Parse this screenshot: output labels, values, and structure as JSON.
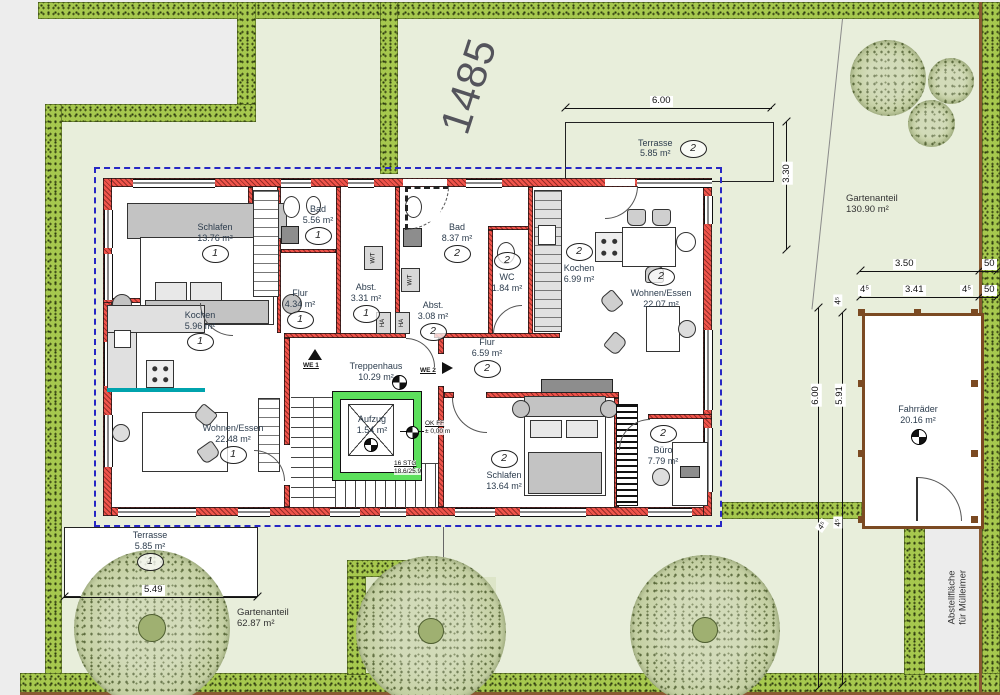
{
  "site": {
    "parcel_number": "1485",
    "garden_share_right": {
      "name": "Gartenanteil",
      "area": "130.90 m²"
    },
    "garden_share_left": {
      "name": "Gartenanteil",
      "area": "62.87 m²"
    },
    "terrace_top": {
      "name": "Terrasse",
      "area": "5.85 m²",
      "apt": "2"
    },
    "terrace_bottom": {
      "name": "Terrasse",
      "area": "5.85 m²",
      "apt": "1"
    },
    "bike_shed": {
      "name": "Fahrräder",
      "area": "20.16 m²"
    },
    "bin_area": {
      "line1": "Abstellfläche",
      "line2": "für Mülleimer"
    }
  },
  "rooms": [
    {
      "name": "Schlafen",
      "area": "13.76 m²",
      "apt": "1"
    },
    {
      "name": "Bad",
      "area": "5.56 m²",
      "apt": "1"
    },
    {
      "name": "Flur",
      "area": "4.34 m²",
      "apt": "1"
    },
    {
      "name": "Abst.",
      "area": "3.31 m²",
      "apt": "1"
    },
    {
      "name": "Kochen",
      "area": "5.96 m²",
      "apt": "1"
    },
    {
      "name": "Wohnen/Essen",
      "area": "22.48 m²",
      "apt": "1"
    },
    {
      "name": "Bad",
      "area": "8.37 m²",
      "apt": "2"
    },
    {
      "name": "WC",
      "area": "1.84 m²",
      "apt": "2"
    },
    {
      "name": "Abst.",
      "area": "3.08 m²",
      "apt": "2"
    },
    {
      "name": "Kochen",
      "area": "6.99 m²",
      "apt": "2"
    },
    {
      "name": "Wohnen/Essen",
      "area": "22.07 m²",
      "apt": "2"
    },
    {
      "name": "Flur",
      "area": "6.59 m²",
      "apt": "2"
    },
    {
      "name": "Schlafen",
      "area": "13.64 m²",
      "apt": "2"
    },
    {
      "name": "Büro",
      "area": "7.79 m²",
      "apt": "2"
    },
    {
      "name": "Treppenhaus",
      "area": "10.29 m²"
    },
    {
      "name": "Aufzug",
      "area": "1.54 m²"
    }
  ],
  "core": {
    "we1": "WE 1",
    "we2": "WE 2",
    "stairs_line1": "16 STG",
    "stairs_line2": "18.6/25.9",
    "level_line1": "OK FF",
    "level_line2": "± 0,00 m",
    "wt": "W/T",
    "ha": "HA"
  },
  "dimensions": {
    "terrace_width": "6.00",
    "terrace_depth": "3.30",
    "shed_row1": "3.50",
    "shed_row1_offset": "50",
    "shed_row2_left": "4⁵",
    "shed_row2": "3.41",
    "shed_row2_right": "4⁵",
    "shed_row2_offset": "50",
    "garden_height": "6.00",
    "shed_height": "5.91",
    "gap_top": "4⁵",
    "gap_bottom": "4⁵",
    "gap_corner": "4⁵",
    "terrace1_width": "5.49"
  },
  "colors": {
    "lawn": "#e8eedb",
    "hedge": "#a6c84e",
    "wall_red": "#f0534a",
    "roof_blue": "#2727c4",
    "lift_green": "#5ce05c",
    "counter_teal": "#00a3ad",
    "wood_brown": "#7b4a22",
    "path_gray": "#ececec",
    "tree_green": "#c6d1a5"
  }
}
